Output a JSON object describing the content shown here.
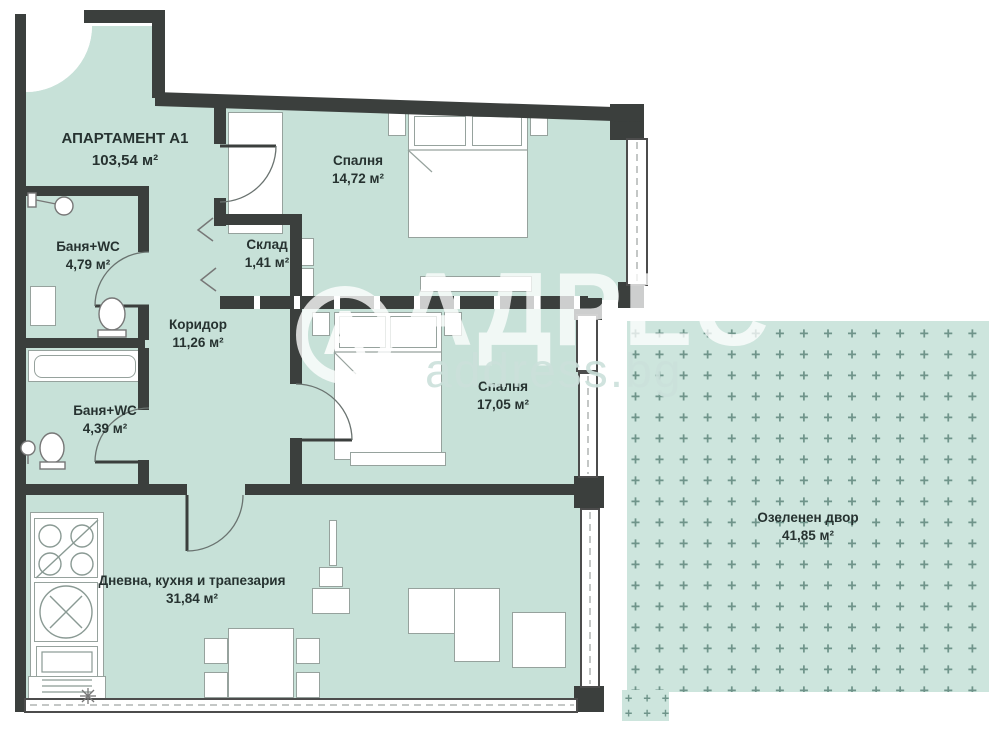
{
  "plan": {
    "title": {
      "name": "АПАРТАМЕНТ А1",
      "area": "103,54 м²"
    },
    "rooms": [
      {
        "id": "bedroom1",
        "name": "Спалня",
        "area": "14,72 м²"
      },
      {
        "id": "bath1",
        "name": "Баня+WC",
        "area": "4,79 м²"
      },
      {
        "id": "storage",
        "name": "Склад",
        "area": "1,41 м²"
      },
      {
        "id": "corridor",
        "name": "Коридор",
        "area": "11,26 м²"
      },
      {
        "id": "bath2",
        "name": "Баня+WC",
        "area": "4,39 м²"
      },
      {
        "id": "bedroom2",
        "name": "Спалня",
        "area": "17,05 м²"
      },
      {
        "id": "living",
        "name": "Дневна, кухня и трапезария",
        "area": "31,84 м²"
      },
      {
        "id": "yard",
        "name": "Озеленен двор",
        "area": "41,85 м²"
      }
    ],
    "watermark": {
      "logo_letter": "А",
      "brand": "АДРЕС",
      "site": "address.bg"
    },
    "colors": {
      "floor": "#c7e1d8",
      "wall": "#3b3f3d",
      "yard_plus": "#6f948a",
      "label_text": "#263230"
    }
  }
}
